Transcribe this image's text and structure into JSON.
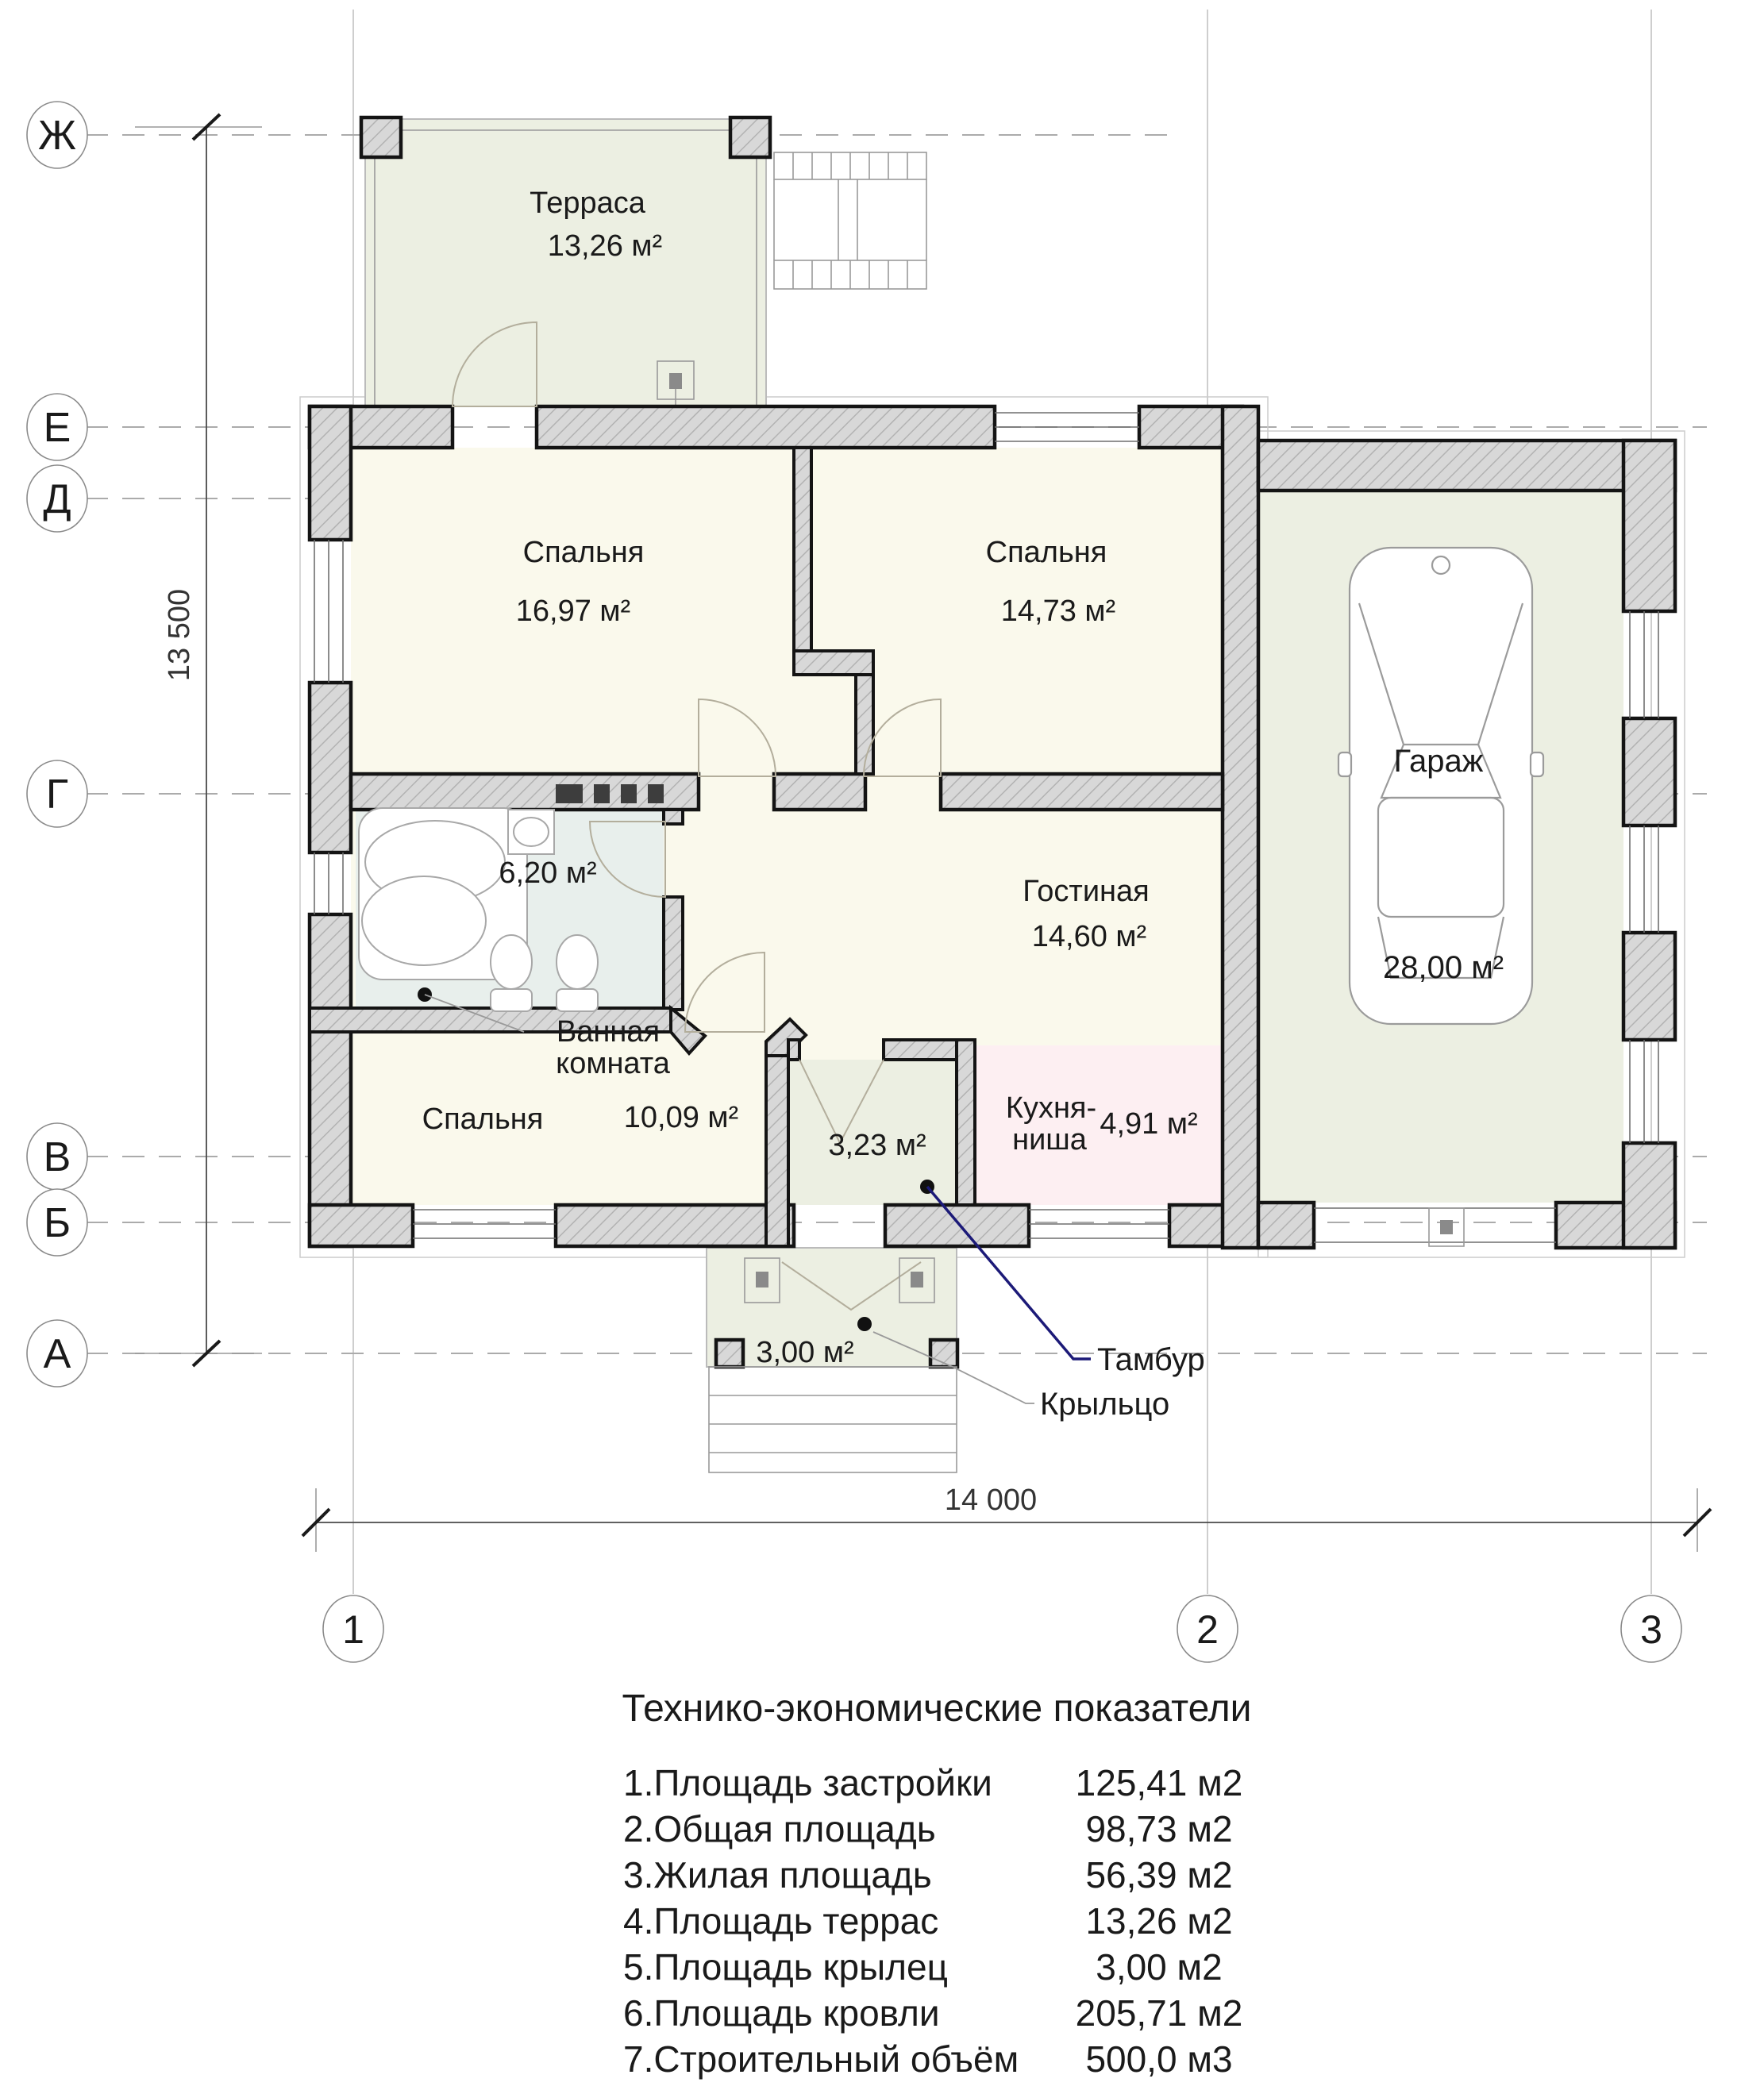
{
  "plan": {
    "rooms": {
      "terrace": {
        "name": "Терраса",
        "area": "13,26 м²"
      },
      "bedroom1": {
        "name": "Спальня",
        "area": "16,97 м²"
      },
      "bedroom2": {
        "name": "Спальня",
        "area": "14,73 м²"
      },
      "garage": {
        "name": "Гараж",
        "area": "28,00 м²"
      },
      "bathroom": {
        "area": "6,20 м²",
        "callout_line1": "Ванная",
        "callout_line2": "комната"
      },
      "living": {
        "name": "Гостиная",
        "area": "14,60 м²"
      },
      "bedroom3": {
        "name": "Спальня",
        "area": "10,09 м²"
      },
      "kitchen": {
        "name_line1": "Кухня-",
        "name_line2": "ниша",
        "area": "4,91 м²"
      },
      "vestibule": {
        "area": "3,23 м²",
        "callout": "Тамбур"
      },
      "porch": {
        "area": "3,00 м²",
        "callout": "Крыльцо"
      }
    },
    "axes": {
      "rows": [
        "Ж",
        "Е",
        "Д",
        "Г",
        "В",
        "Б",
        "А"
      ],
      "cols": [
        "1",
        "2",
        "3"
      ]
    },
    "dimensions": {
      "height": "13 500",
      "width": "14 000"
    }
  },
  "table": {
    "title": "Технико-экономические показатели",
    "rows": [
      {
        "label": "1.Площадь застройки",
        "value": "125,41 м2"
      },
      {
        "label": "2.Общая площадь",
        "value": "98,73 м2"
      },
      {
        "label": "3.Жилая площадь",
        "value": "56,39 м2"
      },
      {
        "label": "4.Площадь террас",
        "value": "13,26 м2"
      },
      {
        "label": "5.Площадь крылец",
        "value": "3,00 м2"
      },
      {
        "label": "6.Площадь кровли",
        "value": "205,71 м2"
      },
      {
        "label": "7.Строительный объём",
        "value": "500,0 м3"
      }
    ]
  },
  "colors": {
    "wall_fill": "#d8d8d8",
    "room_fill": "#faf9ec",
    "service_fill": "#ecefe2",
    "bathroom_fill": "#e8efec",
    "kitchen_fill": "#fdeff2",
    "leader_accent": "#1c1a78"
  }
}
